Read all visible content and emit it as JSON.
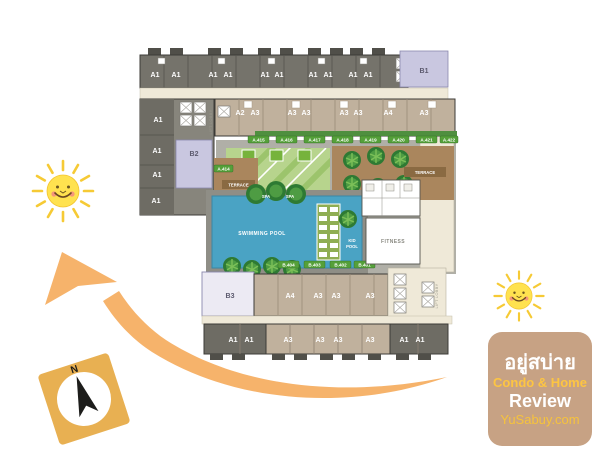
{
  "plan": {
    "top_units": [
      "A1",
      "A1",
      "A1",
      "A1",
      "A1",
      "A1",
      "A1",
      "A1",
      "A1",
      "A1"
    ],
    "row2_units": [
      "A2",
      "A3",
      "A3",
      "A3",
      "A3",
      "A3",
      "A4",
      "A3"
    ],
    "left_units": [
      "A1",
      "A1",
      "A1",
      "A1"
    ],
    "b1": "B1",
    "b2": "B2",
    "b3": "B3",
    "garden_tags": [
      "A.415",
      "A.416",
      "A.417",
      "A.418",
      "A.419",
      "A.420",
      "A.421",
      "A.422"
    ],
    "terrace_tag": "A.414",
    "pool_tags": [
      "B.404",
      "B.403",
      "B.402",
      "B.401"
    ],
    "bottom_row1_units": [
      "A4",
      "A3",
      "A3",
      "A3"
    ],
    "bottom_row2_left": [
      "A1",
      "A1"
    ],
    "bottom_row2_mid": [
      "A3",
      "A3",
      "A3",
      "A3"
    ],
    "bottom_row2_right": [
      "A1",
      "A1"
    ],
    "labels": {
      "swimming_pool": "SWIMMING POOL",
      "kid_line1": "KID",
      "kid_line2": "POOL",
      "fitness": "FITNESS",
      "spa": "SPA",
      "terrace": "TERRACE",
      "lift_lobby": "LIFT LOBBY"
    }
  },
  "compass": {
    "north": "N"
  },
  "brand": {
    "thai": "อยู่สบ่าย",
    "subtitle": "Condo & Home",
    "review": "Review",
    "site": "YuSabuy.com"
  },
  "colors": {
    "arrow": "#f6b36b",
    "sun_body": "#ffe24f",
    "sun_ray": "#f6ca35",
    "pool": "#4aa3c4",
    "lawn": "#b7d48d",
    "terrace": "#aa865d",
    "unit_dark": "#75736b",
    "unit_tan": "#c0b19d",
    "unit_lavender": "#c9c7e0",
    "corridor": "#efe9d8",
    "tag_green": "#55a03a",
    "brand_bg": "#c7a284",
    "brand_yellow": "#fdc542",
    "compass_bg": "#e8b052"
  }
}
